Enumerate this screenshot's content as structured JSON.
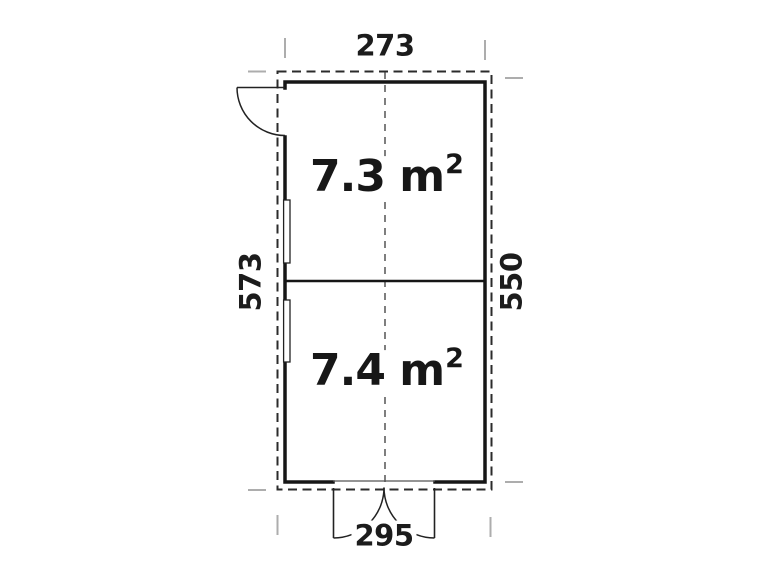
{
  "plan": {
    "type": "floor-plan",
    "dimensions": {
      "top_width": "273",
      "left_depth": "573",
      "right_depth": "550",
      "bottom_width": "295"
    },
    "rooms": [
      {
        "area_text": "7.3 m",
        "sup": "2"
      },
      {
        "area_text": "7.4 m",
        "sup": "2"
      }
    ],
    "colors": {
      "wall": "#161616",
      "outline_dashed": "#2b2b2b",
      "centerline": "#3a3a3a",
      "door": "#222222",
      "tick": "#adadad",
      "text": "#1c1c1c",
      "background": "#ffffff"
    }
  }
}
